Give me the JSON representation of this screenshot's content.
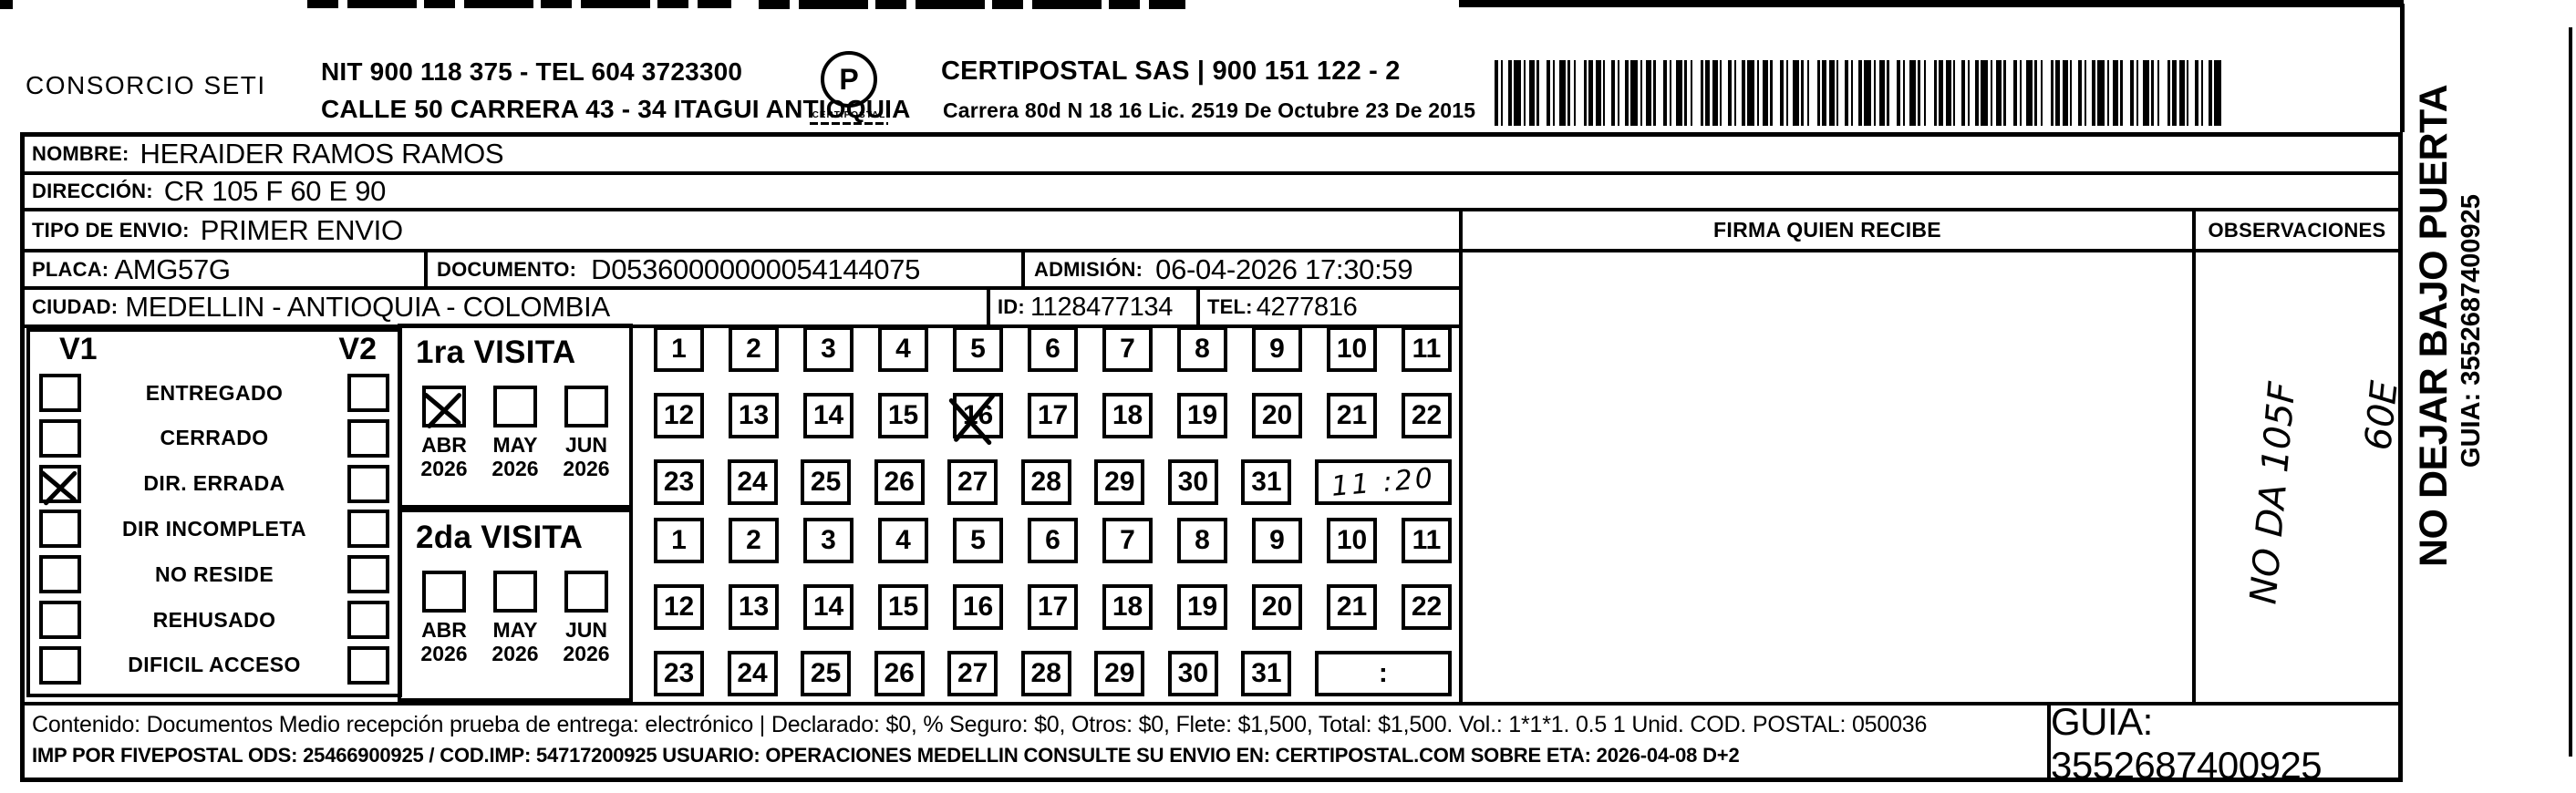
{
  "header": {
    "company": "CONSORCIO SETI",
    "nit_line": "NIT 900 118 375 - TEL 604 3723300",
    "address_line": "CALLE 50 CARRERA 43 - 34 ITAGUI ANTIOQUIA",
    "logo_glyph": "P",
    "logo_word": "CERTIPOSTAL",
    "certipostal_line": "CERTIPOSTAL SAS | 900 151 122 - 2",
    "certipostal_sub": "Carrera 80d N 18 16  Lic. 2519 De Octubre 23 De 2015"
  },
  "recipient": {
    "nombre_label": "NOMBRE:",
    "nombre": "HERAIDER RAMOS RAMOS",
    "direccion_label": "DIRECCIÓN:",
    "direccion": "CR 105 F 60 E 90",
    "tipo_label": "TIPO DE ENVIO:",
    "tipo": "PRIMER ENVIO",
    "placa_label": "PLACA:",
    "placa": "AMG57G",
    "documento_label": "DOCUMENTO:",
    "documento": "D05360000000054144075",
    "admision_label": "ADMISIÓN:",
    "admision": "06-04-2026 17:30:59",
    "ciudad_label": "CIUDAD:",
    "ciudad": "MEDELLIN - ANTIOQUIA - COLOMBIA",
    "id_label": "ID:",
    "id": "1128477134",
    "tel_label": "TEL:",
    "tel": "4277816"
  },
  "columns": {
    "firma": "FIRMA QUIEN RECIBE",
    "observaciones": "OBSERVACIONES"
  },
  "status_panel": {
    "v1": "V1",
    "v2": "V2",
    "options": [
      {
        "label": "ENTREGADO",
        "v1": false,
        "v2": false
      },
      {
        "label": "CERRADO",
        "v1": false,
        "v2": false
      },
      {
        "label": "DIR. ERRADA",
        "v1": true,
        "v2": false
      },
      {
        "label": "DIR INCOMPLETA",
        "v1": false,
        "v2": false
      },
      {
        "label": "NO RESIDE",
        "v1": false,
        "v2": false
      },
      {
        "label": "REHUSADO",
        "v1": false,
        "v2": false
      },
      {
        "label": "DIFICIL ACCESO",
        "v1": false,
        "v2": false
      }
    ]
  },
  "visits": {
    "months": [
      {
        "month": "ABR",
        "year": "2026"
      },
      {
        "month": "MAY",
        "year": "2026"
      },
      {
        "month": "JUN",
        "year": "2026"
      }
    ],
    "first": {
      "title": "1ra VISITA",
      "checked_month": 0,
      "crossed_day": 16,
      "time_note": "11 :20",
      "time_handwritten": true
    },
    "second": {
      "title": "2da VISITA",
      "checked_month": null,
      "crossed_day": null,
      "time_note": ":",
      "time_handwritten": false
    },
    "days_row1": [
      1,
      2,
      3,
      4,
      5,
      6,
      7,
      8,
      9,
      10,
      11
    ],
    "days_row2": [
      12,
      13,
      14,
      15,
      16,
      17,
      18,
      19,
      20,
      21,
      22
    ],
    "days_row3": [
      23,
      24,
      25,
      26,
      27,
      28,
      29,
      30,
      31
    ]
  },
  "observaciones_handwriting": {
    "line1": "NO DA  105F",
    "line2": "60E"
  },
  "side_note": {
    "text": "NO DEJAR BAJO PUERTA",
    "guia": "GUIA: 3552687400925"
  },
  "footer": {
    "line1": "Contenido: Documentos Medio recepción prueba de entrega: electrónico | Declarado: $0, % Seguro: $0, Otros: $0, Flete: $1,500, Total: $1,500. Vol.: 1*1*1. 0.5  1 Unid. COD. POSTAL: 050036",
    "line2": "IMP POR FIVEPOSTAL ODS: 25466900925 / COD.IMP: 54717200925 USUARIO: OPERACIONES MEDELLIN CONSULTE SU ENVIO EN: CERTIPOSTAL.COM SOBRE ETA: 2026-04-08 D+2",
    "guia_box": "GUIA: 3552687400925"
  }
}
